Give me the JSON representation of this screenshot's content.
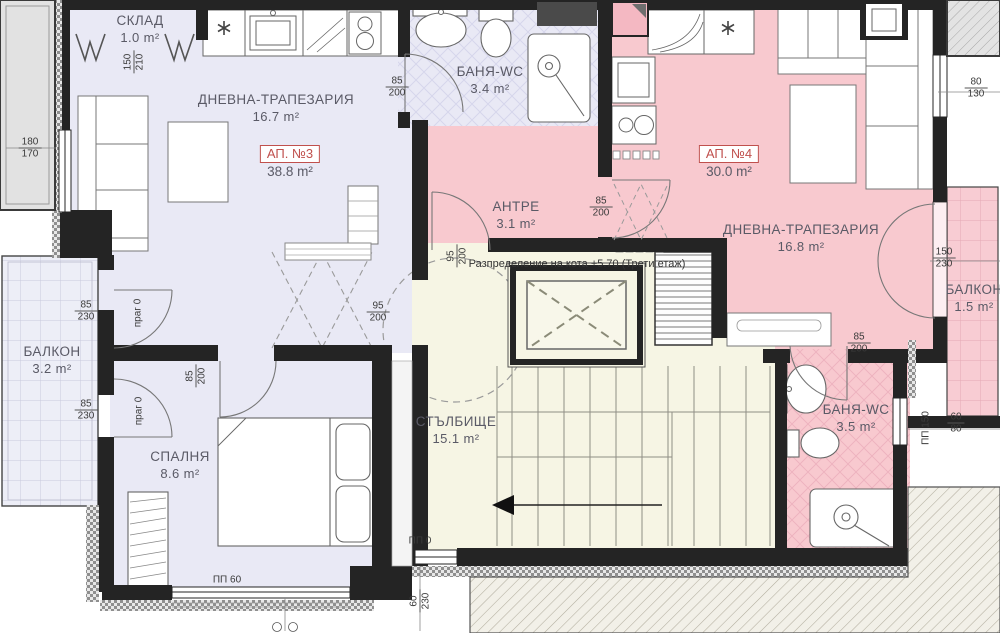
{
  "title": {
    "text": "Разпределение на кота +5.70 (Трети етаж)"
  },
  "apartments": [
    {
      "id": "АП. №3",
      "area": "38.8 m²"
    },
    {
      "id": "АП. №4",
      "area": "30.0 m²"
    }
  ],
  "rooms": [
    {
      "name": "СКЛАД",
      "area": "1.0 m²"
    },
    {
      "name": "ДНЕВНА-ТРАПЕЗАРИЯ",
      "area": "16.7 m²"
    },
    {
      "name": "БАНЯ-WC",
      "area": "3.4 m²"
    },
    {
      "name": "АНТРЕ",
      "area": "3.1 m²"
    },
    {
      "name": "ДНЕВНА-ТРАПЕЗАРИЯ",
      "area": "16.8 m²"
    },
    {
      "name": "БАЛКОН",
      "area": "1.5 m²"
    },
    {
      "name": "БАЛКОН",
      "area": "3.2 m²"
    },
    {
      "name": "СПАЛНЯ",
      "area": "8.6 m²"
    },
    {
      "name": "СТЪЛБИЩЕ",
      "area": "15.1 m²"
    },
    {
      "name": "БАНЯ-WC",
      "area": "3.5 m²"
    }
  ],
  "dims": [
    {
      "top": "150",
      "bottom": "210"
    },
    {
      "top": "180",
      "bottom": "170"
    },
    {
      "top": "85",
      "bottom": "200"
    },
    {
      "top": "85",
      "bottom": "200"
    },
    {
      "top": "95",
      "bottom": "200"
    },
    {
      "top": "95",
      "bottom": "200"
    },
    {
      "top": "85",
      "bottom": "230"
    },
    {
      "text": "праг 0"
    },
    {
      "top": "85",
      "bottom": "230"
    },
    {
      "text": "праг 0"
    },
    {
      "top": "85",
      "bottom": "200"
    },
    {
      "text": "ПП 60"
    },
    {
      "text": "ПП 0"
    },
    {
      "top": "60",
      "bottom": "230"
    },
    {
      "top": "85",
      "bottom": "200"
    },
    {
      "text": "ПП 150"
    },
    {
      "top": "60",
      "bottom": "80"
    },
    {
      "top": "150",
      "bottom": "230"
    },
    {
      "top": "80",
      "bottom": "130"
    }
  ],
  "colors": {
    "ap3_fill": "#e9e9f5",
    "ap4_fill": "#f8c9cf",
    "stair_fill": "#f6f5e4",
    "wall": "#242424",
    "badge_red": "#c0504d",
    "label_text": "#5a5a66"
  }
}
